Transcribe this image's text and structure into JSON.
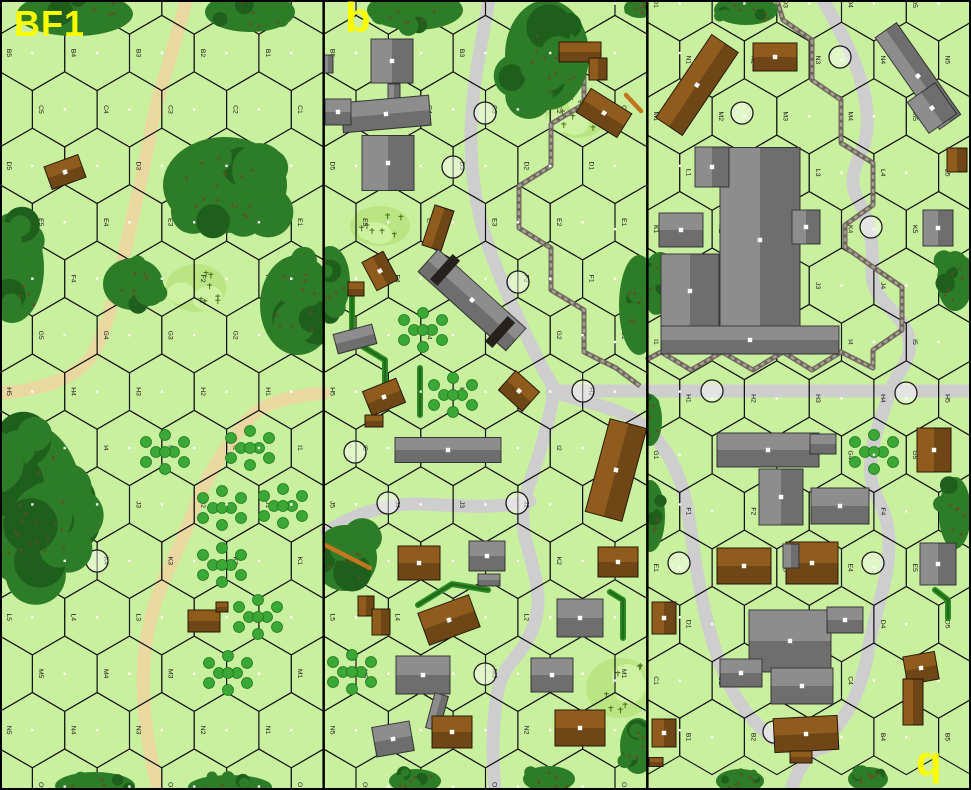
{
  "map": {
    "width": 971,
    "height": 790,
    "boards": [
      {
        "id": "left",
        "label": "BF1",
        "x": 0,
        "orientation": "normal"
      },
      {
        "id": "middle",
        "label": "b",
        "x": 323.67,
        "orientation": "normal"
      },
      {
        "id": "right",
        "label": "b",
        "x": 647.33,
        "orientation": "rotated"
      }
    ],
    "grid": {
      "hexW": 64.73,
      "rowH": 56.43,
      "size": 37.62,
      "boardW": 323.67,
      "cols": 5,
      "rowsNormal": [
        "A",
        "B",
        "C",
        "D",
        "E",
        "F",
        "G",
        "H",
        "I",
        "J",
        "K",
        "L",
        "M",
        "N",
        "O"
      ],
      "rowsRotated": [
        "O",
        "N",
        "M",
        "L",
        "K",
        "J",
        "I",
        "H",
        "G",
        "F",
        "E",
        "D",
        "C",
        "B"
      ],
      "y0Normal": -3.43,
      "y0Rotated": 3.43
    },
    "colors": {
      "bg": "#c9f09e",
      "line": "#141414",
      "label": "#161616",
      "dot": "#ffffff",
      "woods": "#2d7c27",
      "woodsDark": "#1f5f1c",
      "bark": "#6b4a22",
      "orchard": "#3aa736",
      "orchardDark": "#1f7a1e",
      "brush": "#b9e583",
      "brushLight": "#cdf2a2",
      "sprig": "#49701a",
      "roadTan": "#e9d9a0",
      "roadGray": "#cecece",
      "wall": "#6f675e",
      "wallLight": "#a89f93",
      "hedge": "#2e8b25",
      "hedgeDark": "#1e6b18",
      "stone": "#8d8d8d",
      "strokeS": "#3a3a3a",
      "wood": "#8f5c1d",
      "strokeW": "#2c1d07",
      "dark": "#26211c",
      "ring": "#1c1c1c",
      "log": "#c1761f",
      "divider": "#000000",
      "boardLabel": "#fcfc00"
    },
    "features": {
      "orchardPattern": [
        [
          0,
          -17
        ],
        [
          -19,
          -10
        ],
        [
          19,
          -10
        ],
        [
          -9,
          0
        ],
        [
          9,
          0
        ],
        [
          -19,
          10
        ],
        [
          19,
          10
        ],
        [
          0,
          17
        ],
        [
          0,
          0
        ]
      ],
      "roads": [
        {
          "c": "tan",
          "d": "M186,0 C176,45 158,90 151,130 C144,170 133,215 124,255 C116,292 105,335 92,355 C78,377 45,390 0,393"
        },
        {
          "c": "tan",
          "d": "M324,393 C292,396 263,401 245,423 C222,451 205,480 194,510 C176,558 160,580 150,622 C141,660 141,700 149,745 C152,763 155,775 158,790"
        },
        {
          "c": "gray",
          "d": "M489,0 C481,45 471,92 471,136 C471,185 479,222 493,259 C508,298 528,340 543,369 L554,388"
        },
        {
          "c": "gray",
          "d": "M552,391 L971,391"
        },
        {
          "c": "gray",
          "d": "M553,396 C549,424 539,456 528,488 C521,509 521,525 528,549 C538,583 541,600 535,622 C522,662 503,658 497,696 C492,728 492,755 495,790"
        },
        {
          "c": "gray",
          "d": "M530,501 C498,509 462,506 421,504 C395,503 362,511 336,526 L327,532"
        },
        {
          "c": "gray",
          "d": "M823,0 C840,30 856,60 862,85 C868,105 870,130 862,150 C852,172 850,185 858,200 C868,218 874,240 872,270 C870,300 900,310 908,335 C915,360 896,372 890,391"
        },
        {
          "c": "gray",
          "d": "M890,391 C880,424 868,446 871,478 C874,500 888,508 889,540 C890,580 874,612 868,652 C861,692 846,722 816,749 C806,758 797,770 791,790"
        },
        {
          "c": "gray",
          "d": "M556,393 C601,406 627,411 646,428 C667,447 682,476 688,512 C696,568 702,610 716,652 C729,692 748,722 779,742 C794,751 812,753 827,746"
        }
      ],
      "walls": [
        [
          [
            551,
            0
          ],
          [
            551,
            42
          ],
          [
            584,
            62
          ],
          [
            584,
            104
          ],
          [
            551,
            124
          ],
          [
            551,
            166
          ],
          [
            519,
            186
          ],
          [
            519,
            228
          ],
          [
            551,
            248
          ],
          [
            551,
            290
          ],
          [
            584,
            310
          ],
          [
            584,
            352
          ],
          [
            616,
            368
          ],
          [
            640,
            386
          ]
        ],
        [
          [
            777,
            0
          ],
          [
            783,
            20
          ],
          [
            812,
            40
          ],
          [
            812,
            80
          ],
          [
            841,
            100
          ],
          [
            841,
            143
          ],
          [
            873,
            163
          ],
          [
            873,
            205
          ],
          [
            845,
            225
          ],
          [
            845,
            247
          ],
          [
            873,
            267
          ],
          [
            902,
            287
          ],
          [
            902,
            330
          ],
          [
            873,
            350
          ],
          [
            873,
            368
          ],
          [
            841,
            352
          ],
          [
            812,
            370
          ],
          [
            783,
            352
          ],
          [
            753,
            370
          ],
          [
            722,
            352
          ],
          [
            691,
            370
          ],
          [
            661,
            352
          ],
          [
            646,
            360
          ]
        ]
      ],
      "hedges": [
        [
          [
            352,
            292
          ],
          [
            352,
            340
          ],
          [
            385,
            360
          ],
          [
            385,
            407
          ]
        ],
        [
          [
            420,
            368
          ],
          [
            420,
            415
          ]
        ],
        [
          [
            418,
            605
          ],
          [
            452,
            584
          ],
          [
            488,
            590
          ]
        ],
        [
          [
            610,
            592
          ],
          [
            623,
            600
          ],
          [
            623,
            638
          ]
        ],
        [
          [
            935,
            590
          ],
          [
            948,
            600
          ],
          [
            948,
            618
          ]
        ]
      ],
      "woods": [
        [
          75,
          14,
          58,
          22
        ],
        [
          250,
          12,
          45,
          20
        ],
        [
          225,
          185,
          62,
          48
        ],
        [
          12,
          268,
          32,
          55
        ],
        [
          133,
          284,
          30,
          26
        ],
        [
          298,
          305,
          38,
          50
        ],
        [
          28,
          505,
          55,
          82
        ],
        [
          95,
          786,
          40,
          14
        ],
        [
          230,
          787,
          42,
          12
        ],
        [
          415,
          10,
          48,
          20
        ],
        [
          547,
          55,
          42,
          55
        ],
        [
          330,
          282,
          20,
          36
        ],
        [
          639,
          305,
          20,
          50
        ],
        [
          345,
          558,
          32,
          33
        ],
        [
          415,
          781,
          26,
          12
        ],
        [
          549,
          779,
          26,
          13
        ],
        [
          638,
          746,
          18,
          28
        ],
        [
          640,
          8,
          16,
          10
        ],
        [
          746,
          10,
          32,
          15
        ],
        [
          660,
          282,
          18,
          30
        ],
        [
          650,
          420,
          12,
          26
        ],
        [
          955,
          281,
          18,
          30
        ],
        [
          650,
          516,
          15,
          36
        ],
        [
          955,
          513,
          16,
          36
        ],
        [
          740,
          781,
          24,
          12
        ],
        [
          868,
          779,
          20,
          12
        ]
      ],
      "brush": [
        [
          196,
          288,
          30,
          24
        ],
        [
          577,
          112,
          32,
          26
        ],
        [
          380,
          226,
          30,
          20
        ],
        [
          620,
          688,
          34,
          30
        ]
      ],
      "orchards": [
        [
          165,
          452
        ],
        [
          250,
          448
        ],
        [
          222,
          508
        ],
        [
          283,
          506
        ],
        [
          222,
          565
        ],
        [
          258,
          617
        ],
        [
          228,
          673
        ],
        [
          423,
          330
        ],
        [
          453,
          395
        ],
        [
          352,
          672
        ],
        [
          874,
          452
        ]
      ],
      "rings": [
        [
          97,
          561
        ],
        [
          485,
          113
        ],
        [
          453,
          167
        ],
        [
          518,
          282
        ],
        [
          583,
          391
        ],
        [
          355,
          452
        ],
        [
          388,
          503
        ],
        [
          517,
          503
        ],
        [
          485,
          674
        ],
        [
          840,
          57
        ],
        [
          742,
          113
        ],
        [
          871,
          227
        ],
        [
          712,
          391
        ],
        [
          906,
          393
        ],
        [
          679,
          563
        ],
        [
          873,
          563
        ],
        [
          774,
          732
        ]
      ],
      "logs": [
        [
          325,
          545,
          370,
          568
        ],
        [
          626,
          95,
          641,
          111
        ]
      ],
      "buildings": [
        [
          65,
          172,
          36,
          24,
          -20,
          "w"
        ],
        [
          204,
          621,
          32,
          22,
          0,
          "w"
        ],
        [
          222,
          607,
          12,
          10,
          0,
          "w"
        ],
        [
          392,
          61,
          42,
          44,
          0,
          "s"
        ],
        [
          394,
          97,
          12,
          26,
          0,
          "s"
        ],
        [
          386,
          114,
          88,
          30,
          -5,
          "s"
        ],
        [
          338,
          112,
          26,
          26,
          0,
          "s"
        ],
        [
          388,
          163,
          52,
          55,
          0,
          "s"
        ],
        [
          328,
          64,
          10,
          18,
          0,
          "s"
        ],
        [
          580,
          52,
          42,
          20,
          0,
          "w"
        ],
        [
          598,
          69,
          18,
          22,
          0,
          "w"
        ],
        [
          604,
          113,
          48,
          28,
          32,
          "w"
        ],
        [
          380,
          271,
          24,
          32,
          -28,
          "w"
        ],
        [
          356,
          289,
          16,
          14,
          0,
          "w"
        ],
        [
          438,
          228,
          20,
          42,
          18,
          "w"
        ],
        [
          472,
          300,
          118,
          30,
          42,
          "s"
        ],
        [
          445,
          270,
          10,
          34,
          42,
          "d"
        ],
        [
          500,
          332,
          10,
          34,
          42,
          "d"
        ],
        [
          519,
          391,
          32,
          26,
          42,
          "w"
        ],
        [
          355,
          339,
          40,
          20,
          -15,
          "s"
        ],
        [
          384,
          397,
          36,
          26,
          -22,
          "w"
        ],
        [
          374,
          421,
          18,
          12,
          0,
          "w"
        ],
        [
          448,
          450,
          106,
          25,
          0,
          "s"
        ],
        [
          616,
          470,
          38,
          96,
          15,
          "w"
        ],
        [
          419,
          563,
          42,
          34,
          0,
          "w"
        ],
        [
          487,
          556,
          36,
          30,
          0,
          "s"
        ],
        [
          489,
          580,
          22,
          12,
          0,
          "s"
        ],
        [
          618,
          562,
          40,
          30,
          0,
          "w"
        ],
        [
          366,
          606,
          16,
          20,
          0,
          "w"
        ],
        [
          381,
          622,
          18,
          26,
          0,
          "w"
        ],
        [
          449,
          620,
          54,
          34,
          -20,
          "w"
        ],
        [
          580,
          618,
          46,
          38,
          0,
          "s"
        ],
        [
          423,
          675,
          54,
          38,
          0,
          "s"
        ],
        [
          437,
          712,
          14,
          36,
          15,
          "s"
        ],
        [
          552,
          675,
          42,
          34,
          0,
          "s"
        ],
        [
          393,
          739,
          38,
          30,
          -10,
          "s"
        ],
        [
          452,
          732,
          40,
          32,
          0,
          "w"
        ],
        [
          580,
          728,
          50,
          36,
          0,
          "w"
        ],
        [
          697,
          85,
          32,
          100,
          34,
          "w"
        ],
        [
          775,
          57,
          44,
          28,
          0,
          "w"
        ],
        [
          918,
          76,
          26,
          112,
          -35,
          "s"
        ],
        [
          932,
          108,
          34,
          38,
          -35,
          "s"
        ],
        [
          957,
          160,
          20,
          24,
          0,
          "w"
        ],
        [
          938,
          228,
          30,
          36,
          0,
          "s"
        ],
        [
          760,
          240,
          80,
          185,
          0,
          "s"
        ],
        [
          690,
          291,
          58,
          74,
          0,
          "s"
        ],
        [
          712,
          167,
          34,
          40,
          0,
          "s"
        ],
        [
          681,
          230,
          44,
          34,
          0,
          "s"
        ],
        [
          806,
          227,
          28,
          34,
          0,
          "s"
        ],
        [
          750,
          340,
          178,
          28,
          0,
          "s"
        ],
        [
          768,
          450,
          102,
          34,
          0,
          "s"
        ],
        [
          781,
          497,
          44,
          56,
          0,
          "s"
        ],
        [
          823,
          444,
          26,
          20,
          0,
          "s"
        ],
        [
          840,
          506,
          58,
          36,
          0,
          "s"
        ],
        [
          934,
          450,
          34,
          44,
          0,
          "w"
        ],
        [
          938,
          564,
          36,
          42,
          0,
          "s"
        ],
        [
          744,
          566,
          54,
          36,
          0,
          "w"
        ],
        [
          812,
          563,
          52,
          42,
          0,
          "w"
        ],
        [
          791,
          556,
          16,
          24,
          0,
          "s"
        ],
        [
          664,
          618,
          24,
          32,
          0,
          "w"
        ],
        [
          790,
          641,
          82,
          62,
          0,
          "s"
        ],
        [
          802,
          686,
          62,
          36,
          0,
          "s"
        ],
        [
          741,
          673,
          42,
          28,
          0,
          "s"
        ],
        [
          845,
          620,
          36,
          26,
          0,
          "s"
        ],
        [
          921,
          668,
          32,
          28,
          -10,
          "w"
        ],
        [
          913,
          702,
          20,
          46,
          0,
          "w"
        ],
        [
          806,
          734,
          64,
          34,
          -3,
          "w"
        ],
        [
          801,
          757,
          22,
          12,
          0,
          "w"
        ],
        [
          664,
          733,
          24,
          28,
          0,
          "w"
        ],
        [
          656,
          762,
          14,
          9,
          0,
          "w"
        ]
      ]
    }
  }
}
